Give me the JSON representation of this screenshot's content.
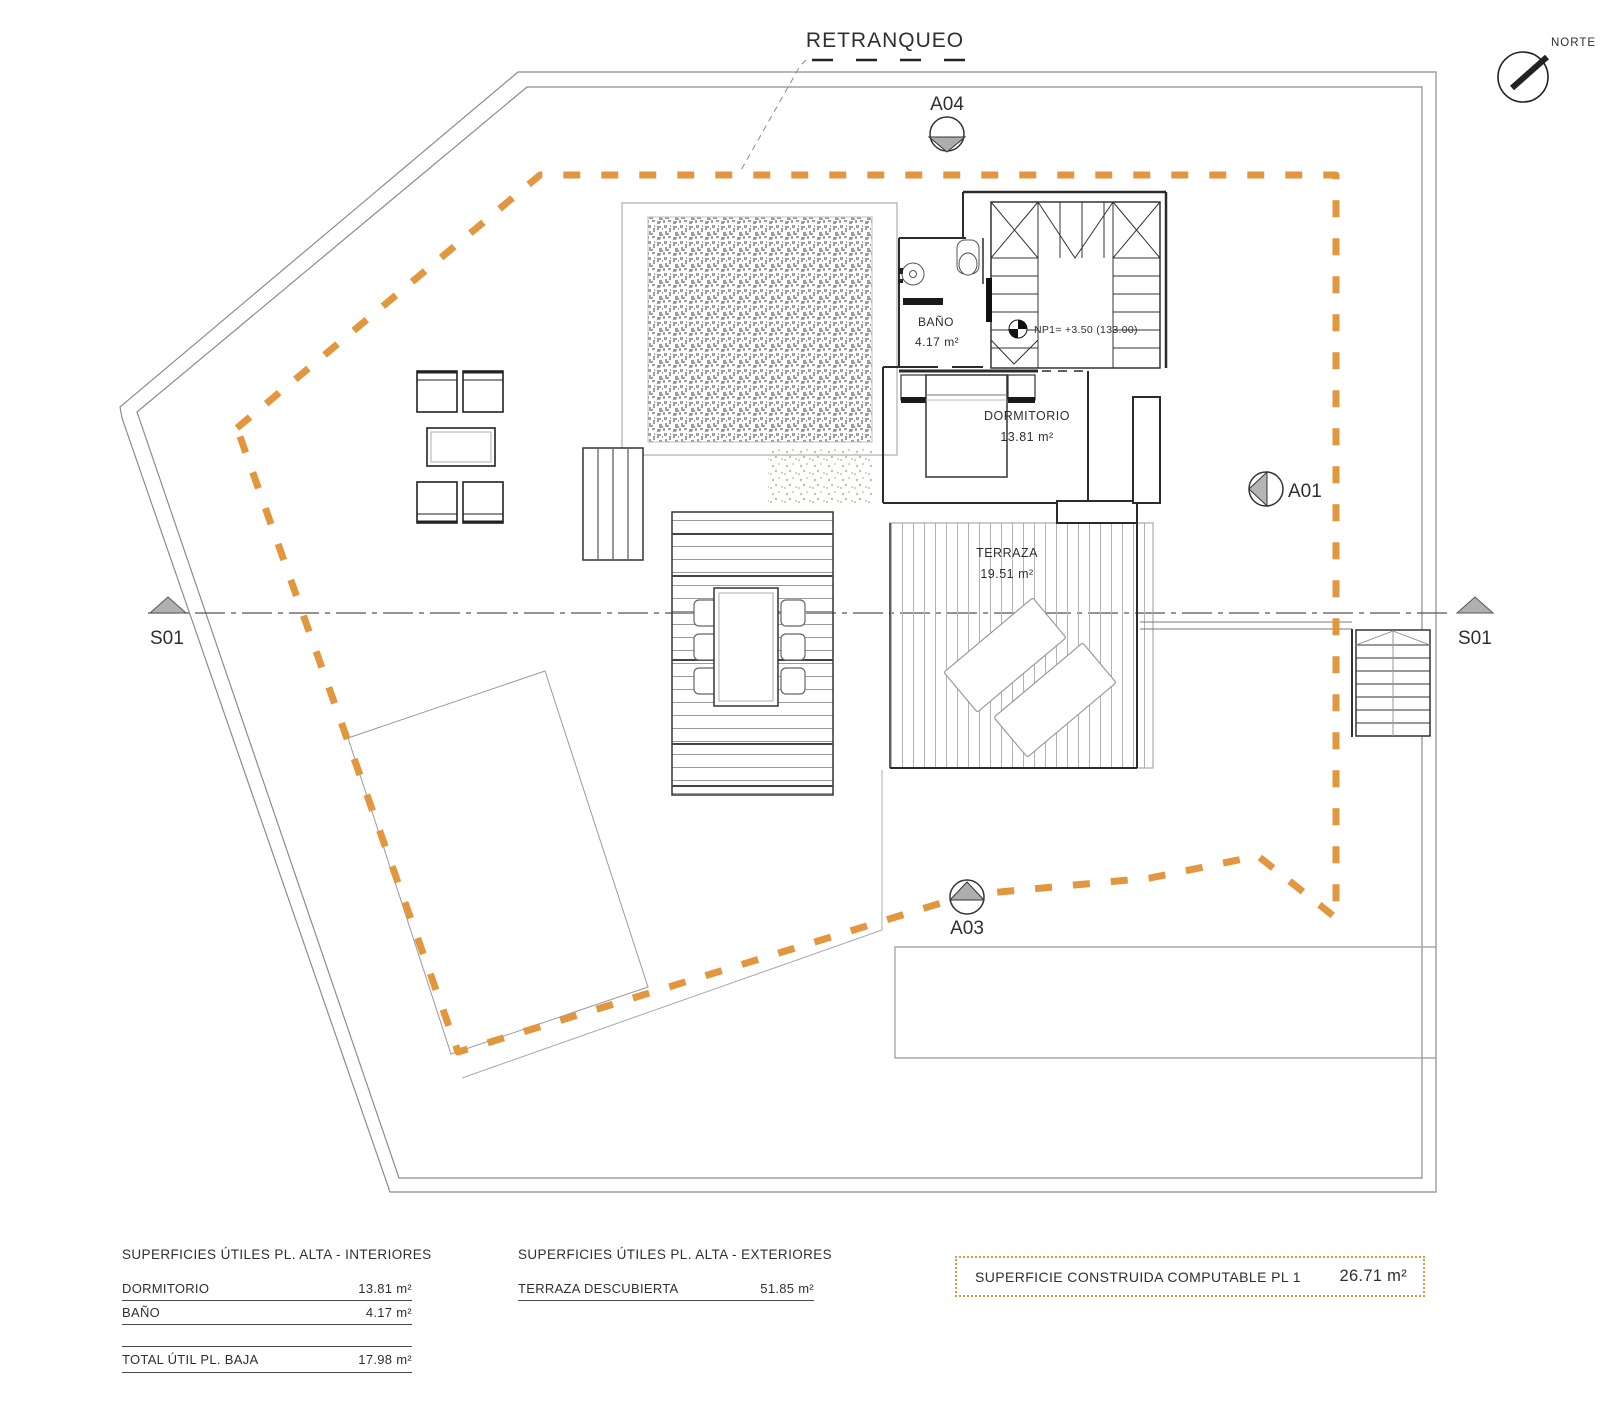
{
  "title": {
    "retranqueo": "RETRANQUEO"
  },
  "compass": {
    "label": "NORTE"
  },
  "markers": {
    "a04": "A04",
    "a01": "A01",
    "a03": "A03",
    "s01_left": "S01",
    "s01_right": "S01"
  },
  "rooms": {
    "bano": {
      "name": "BAÑO",
      "area": "4.17 m²"
    },
    "dormitorio": {
      "name": "DORMITORIO",
      "area": "13.81 m²"
    },
    "terraza": {
      "name": "TERRAZA",
      "area": "19.51 m²"
    }
  },
  "level_marker": {
    "text": "NP1= +3.50 (133.00)"
  },
  "colors": {
    "setback_orange": "#E2963D",
    "wall_black": "#2b2b2b",
    "boundary_gray": "#8c8c8c",
    "marker_gray": "#aeaeae"
  },
  "tables": {
    "interiores": {
      "title": "SUPERFICIES ÚTILES PL. ALTA - INTERIORES",
      "rows": [
        {
          "label": "DORMITORIO",
          "value": "13.81 m²"
        },
        {
          "label": "BAÑO",
          "value": "4.17 m²"
        }
      ],
      "total": {
        "label": "TOTAL ÚTIL PL. BAJA",
        "value": "17.98 m²"
      }
    },
    "exteriores": {
      "title": "SUPERFICIES ÚTILES PL. ALTA - EXTERIORES",
      "rows": [
        {
          "label": "TERRAZA DESCUBIERTA",
          "value": "51.85 m²"
        }
      ]
    },
    "computable": {
      "label": "SUPERFICIE CONSTRUIDA COMPUTABLE PL 1",
      "value": "26.71 m²"
    }
  }
}
